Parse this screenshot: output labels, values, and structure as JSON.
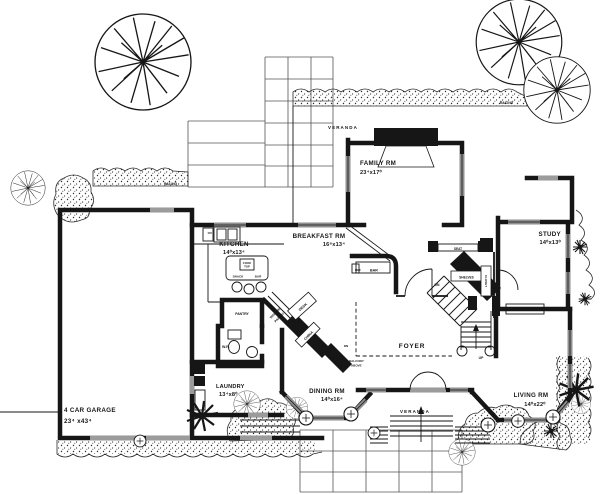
{
  "plan": {
    "type": "house-floor-plan",
    "rooms": {
      "family": {
        "name": "FAMILY RM",
        "dims": "23⁴x17⁰"
      },
      "kitchen": {
        "name": "KITCHEN",
        "dims": "14⁰x13⁴"
      },
      "breakfast": {
        "name": "BREAKFAST RM",
        "dims": "16⁸x13⁴"
      },
      "study": {
        "name": "STUDY",
        "dims": "14⁰x13⁰"
      },
      "dining": {
        "name": "DINING RM",
        "dims": "14⁰x16⁴"
      },
      "living": {
        "name": "LIVING RM",
        "dims": "14⁰x22⁰"
      },
      "laundry": {
        "name": "LAUNDRY",
        "dims": "13⁴x8⁰"
      },
      "garage": {
        "name": "4 CAR GARAGE",
        "dims": "23⁴ x43⁴"
      },
      "foyer": {
        "name": "FOYER"
      },
      "veranda": {
        "name": "VERANDA"
      }
    },
    "labels": {
      "railing": "RAILING",
      "pantry": "PANTRY",
      "walkin_1": "WALK-IN",
      "walkin_2": "PANTRY",
      "wr": "W.R.",
      "china": "CHINA",
      "desk": "DESK",
      "bar": "BAR",
      "ref": "REF",
      "ov": "OV",
      "cook_1": "COOK",
      "cook_2": "TOP",
      "snack": "SNACK",
      "snack_bar": "BAR",
      "seat": "SEAT",
      "shelves": "SHELVES",
      "closet": "CLOSET",
      "dn": "DN",
      "up": "UP",
      "balcony_1": "BALCONY",
      "balcony_2": "ABOVE"
    },
    "colors": {
      "ink": "#161616",
      "paper": "#ffffff",
      "opening_gray": "#8f8f8f"
    }
  }
}
